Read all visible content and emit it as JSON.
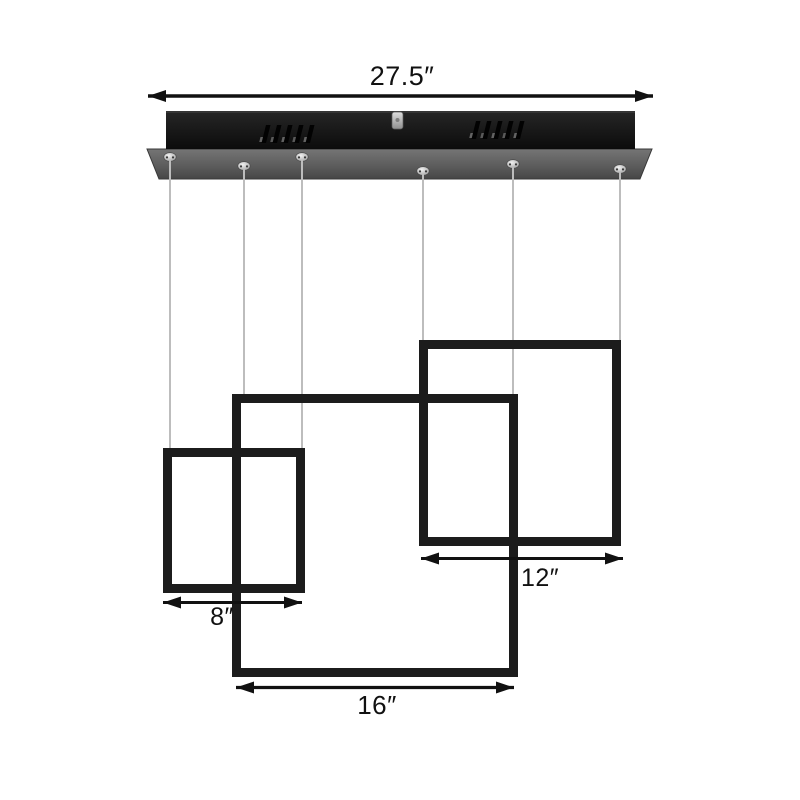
{
  "annotations": {
    "canopy_width_label": "27.5″",
    "small_square_label": "8″",
    "medium_square_label": "12″",
    "large_square_label": "16″"
  },
  "colors": {
    "background": "#ffffff",
    "frame_black": "#1c1c1c",
    "canopy_bar": "#141414",
    "canopy_plate_top": "#6f6f6f",
    "canopy_plate_bottom": "#4a4a4a",
    "cable_gray": "#bdbdbd",
    "metal_silver": "#c9c9c9",
    "annotation_black": "#111111"
  }
}
